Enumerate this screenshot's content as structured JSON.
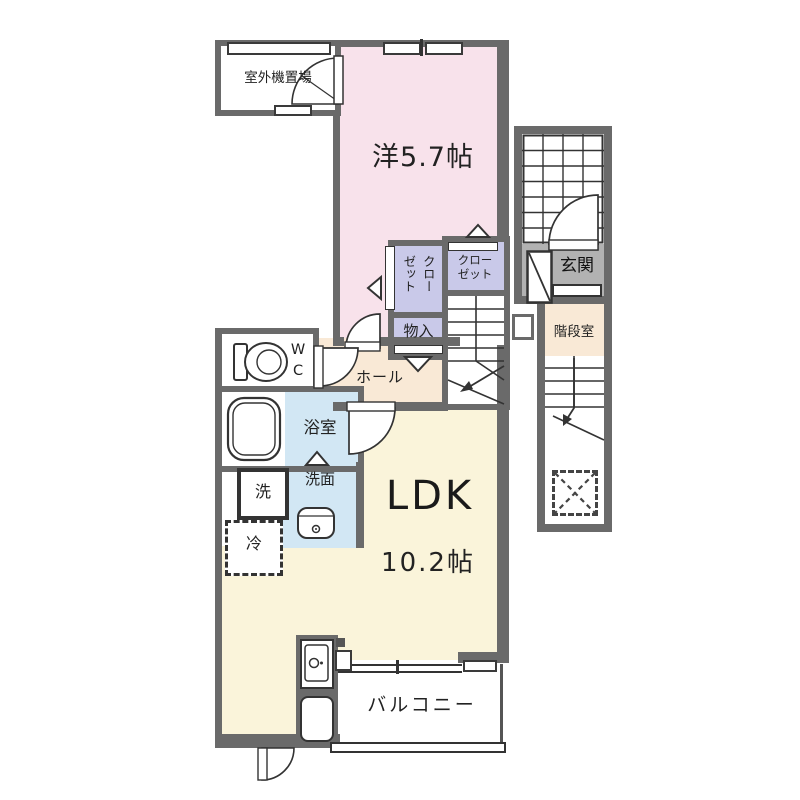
{
  "plan_type": "apartment-floor-plan",
  "rooms": {
    "outdoor_unit_label": "室外機置場",
    "western_room_label": "洋5.7帖",
    "closet_vertical_label": "クローゼット",
    "closet_horizontal_label": "クローゼット",
    "storage_label": "物入",
    "hall_label": "ホール",
    "wc_line1": "W",
    "wc_line2": "C",
    "bath_label": "浴室",
    "laundry_label": "洗",
    "washroom_label": "洗面",
    "fridge_label": "冷",
    "ldk_label": "LDK",
    "ldk_size_label": "10.2帖",
    "balcony_label": "バルコニー",
    "entrance_label": "玄関",
    "stairwell_label": "階段室"
  },
  "colors": {
    "wall": "#6a6a6a",
    "western_room_pink": "#f8e2eb",
    "closet_lavender": "#c9c9e9",
    "hall_beige": "#f9e9d6",
    "bath_blue": "#d2e7f4",
    "ldk_cream": "#faf4da",
    "entrance_gray": "#b2b2b2",
    "line": "#333333"
  },
  "icons": [
    "window-icon",
    "door-swing-icon",
    "toilet-icon",
    "bathtub-icon",
    "washbasin-icon",
    "kitchen-sink-icon",
    "kitchen-counter-icon",
    "stairs-icon",
    "stairs-arrow-icon",
    "exterior-stair-grid-icon",
    "void-cross-icon",
    "shoe-cabinet-icon",
    "folding-door-marker-icon"
  ]
}
